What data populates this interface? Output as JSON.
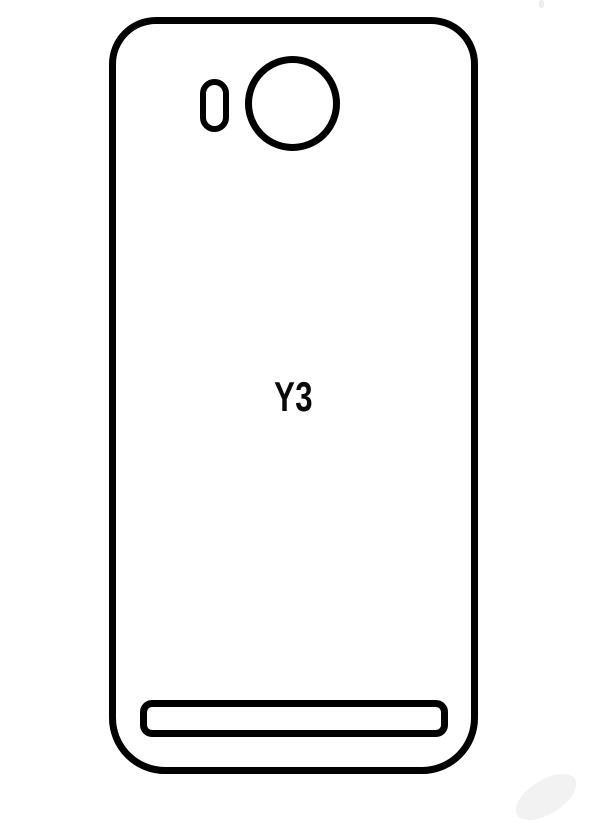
{
  "diagram": {
    "kind": "phone-back-protector-template",
    "model_label": "Y3",
    "line_color": "#000000",
    "background_color": "#ffffff",
    "shapes": [
      {
        "name": "phone-back-outline",
        "type": "rounded-rectangle-outline"
      },
      {
        "name": "flash-cutout",
        "type": "pill-outline"
      },
      {
        "name": "camera-cutout",
        "type": "circle-outline"
      },
      {
        "name": "bottom-port-cutout",
        "type": "rounded-slot-outline"
      }
    ]
  }
}
